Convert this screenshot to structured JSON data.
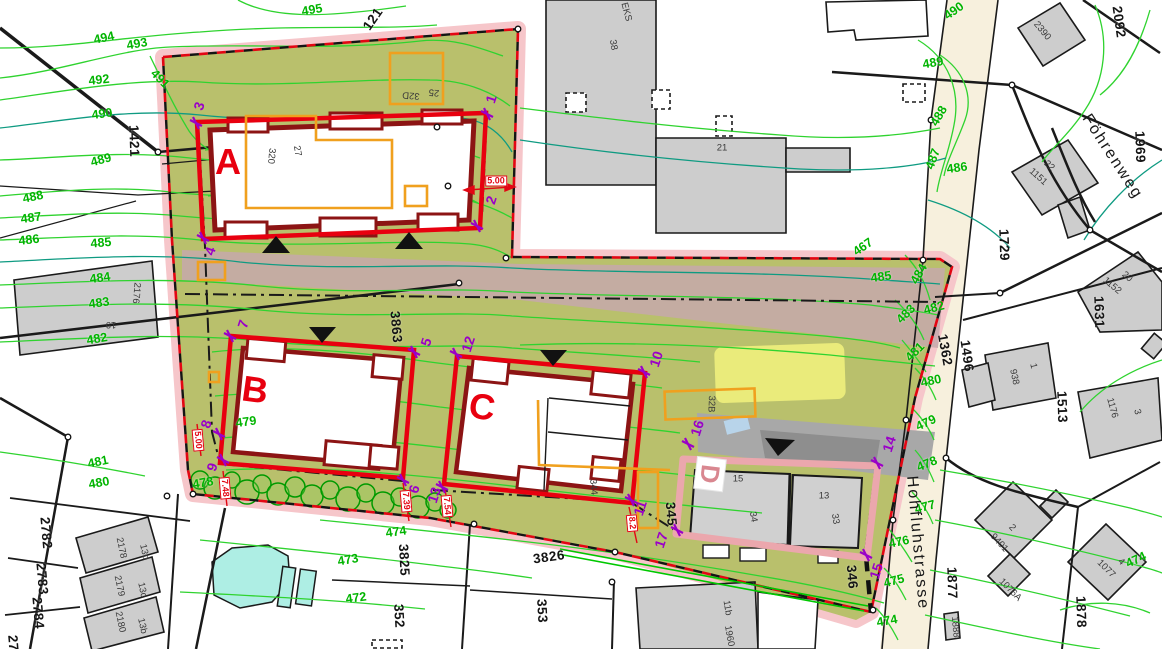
{
  "map": {
    "title": "site-development-plan",
    "colors": {
      "site_area": "#b9c06c",
      "boundary_band": "#f6c6ca",
      "road_reserve": "#c5a8ab",
      "street_fill": "#f7f0dd",
      "special_zone_yellow": "#f2f27e",
      "water": "#aeeee4",
      "contour": "#2fd32f",
      "contour_index": "#0f9b82",
      "contour_label": "#00b400",
      "new_building_red": "#e8000f",
      "wall_maroon": "#8c1414",
      "demolition_orange": "#f0a01e",
      "survey_purple": "#9a00c8",
      "existing_building_gray": "#cdcdcd"
    },
    "streets": [
      {
        "t": "Föhrenweg",
        "x": 1112,
        "y": 157,
        "r": 57
      },
      {
        "t": "Hohfluhstrasse",
        "x": 917,
        "y": 543,
        "r": 85
      }
    ],
    "blocks": [
      {
        "t": "A",
        "x": 228,
        "y": 162,
        "r": 0
      },
      {
        "t": "B",
        "x": 255,
        "y": 390,
        "r": 8
      },
      {
        "t": "C",
        "x": 482,
        "y": 407,
        "r": 8
      },
      {
        "t": "D",
        "x": 710,
        "y": 474,
        "r": 97,
        "boxed": true
      }
    ],
    "contours": [
      {
        "t": "495",
        "x": 312,
        "y": 10,
        "r": -10
      },
      {
        "t": "494",
        "x": 104,
        "y": 38,
        "r": -12
      },
      {
        "t": "493",
        "x": 137,
        "y": 44,
        "r": -10
      },
      {
        "t": "492",
        "x": 99,
        "y": 80,
        "r": -6
      },
      {
        "t": "491",
        "x": 160,
        "y": 79,
        "r": 45
      },
      {
        "t": "490",
        "x": 102,
        "y": 114,
        "r": -8
      },
      {
        "t": "489",
        "x": 101,
        "y": 160,
        "r": -15
      },
      {
        "t": "488",
        "x": 33,
        "y": 197,
        "r": -12
      },
      {
        "t": "487",
        "x": 31,
        "y": 218,
        "r": -8
      },
      {
        "t": "486",
        "x": 29,
        "y": 240,
        "r": -6
      },
      {
        "t": "485",
        "x": 101,
        "y": 243,
        "r": -5
      },
      {
        "t": "484",
        "x": 100,
        "y": 278,
        "r": -8
      },
      {
        "t": "483",
        "x": 99,
        "y": 303,
        "r": -8
      },
      {
        "t": "482",
        "x": 97,
        "y": 339,
        "r": -10
      },
      {
        "t": "481",
        "x": 98,
        "y": 462,
        "r": -12
      },
      {
        "t": "480",
        "x": 99,
        "y": 483,
        "r": -10
      },
      {
        "t": "479",
        "x": 246,
        "y": 422,
        "r": -8
      },
      {
        "t": "478",
        "x": 203,
        "y": 483,
        "r": -10
      },
      {
        "t": "474",
        "x": 396,
        "y": 532,
        "r": -8
      },
      {
        "t": "473",
        "x": 348,
        "y": 560,
        "r": -10
      },
      {
        "t": "472",
        "x": 356,
        "y": 598,
        "r": -8
      },
      {
        "t": "490",
        "x": 954,
        "y": 11,
        "r": -35
      },
      {
        "t": "489",
        "x": 933,
        "y": 63,
        "r": -10
      },
      {
        "t": "488",
        "x": 939,
        "y": 116,
        "r": -60
      },
      {
        "t": "487",
        "x": 933,
        "y": 159,
        "r": -70
      },
      {
        "t": "486",
        "x": 957,
        "y": 168,
        "r": -8
      },
      {
        "t": "485",
        "x": 881,
        "y": 277,
        "r": -8
      },
      {
        "t": "484",
        "x": 919,
        "y": 274,
        "r": -60
      },
      {
        "t": "483",
        "x": 906,
        "y": 314,
        "r": -45
      },
      {
        "t": "482",
        "x": 934,
        "y": 308,
        "r": -15
      },
      {
        "t": "481",
        "x": 915,
        "y": 352,
        "r": -45
      },
      {
        "t": "480",
        "x": 931,
        "y": 381,
        "r": -12
      },
      {
        "t": "479",
        "x": 926,
        "y": 423,
        "r": -25
      },
      {
        "t": "478",
        "x": 927,
        "y": 464,
        "r": -22
      },
      {
        "t": "477",
        "x": 925,
        "y": 507,
        "r": -15
      },
      {
        "t": "476",
        "x": 899,
        "y": 542,
        "r": -12
      },
      {
        "t": "475",
        "x": 894,
        "y": 581,
        "r": -15
      },
      {
        "t": "474",
        "x": 887,
        "y": 621,
        "r": -10
      },
      {
        "t": "474",
        "x": 1136,
        "y": 560,
        "r": -25
      },
      {
        "t": "467",
        "x": 863,
        "y": 247,
        "r": -35
      }
    ],
    "parcels": [
      {
        "t": "1421",
        "x": 134,
        "y": 141,
        "r": 88
      },
      {
        "t": "121",
        "x": 373,
        "y": 19,
        "r": -55
      },
      {
        "t": "3863",
        "x": 396,
        "y": 327,
        "r": 85
      },
      {
        "t": "2782",
        "x": 46,
        "y": 533,
        "r": 85
      },
      {
        "t": "2783",
        "x": 42,
        "y": 579,
        "r": 85
      },
      {
        "t": "2784",
        "x": 38,
        "y": 613,
        "r": 85
      },
      {
        "t": "27",
        "x": 13,
        "y": 643,
        "r": 85
      },
      {
        "t": "3825",
        "x": 404,
        "y": 560,
        "r": 87
      },
      {
        "t": "3826",
        "x": 549,
        "y": 557,
        "r": -8
      },
      {
        "t": "352",
        "x": 399,
        "y": 616,
        "r": 87
      },
      {
        "t": "353",
        "x": 542,
        "y": 611,
        "r": 87
      },
      {
        "t": "345",
        "x": 671,
        "y": 514,
        "r": 85
      },
      {
        "t": "346",
        "x": 852,
        "y": 577,
        "r": 85
      },
      {
        "t": "1362",
        "x": 945,
        "y": 350,
        "r": 80
      },
      {
        "t": "1496",
        "x": 967,
        "y": 356,
        "r": 82
      },
      {
        "t": "1513",
        "x": 1062,
        "y": 407,
        "r": 88
      },
      {
        "t": "1631",
        "x": 1099,
        "y": 312,
        "r": 88
      },
      {
        "t": "1729",
        "x": 1004,
        "y": 245,
        "r": 88
      },
      {
        "t": "1877",
        "x": 952,
        "y": 583,
        "r": 88
      },
      {
        "t": "1878",
        "x": 1081,
        "y": 612,
        "r": 88
      },
      {
        "t": "1969",
        "x": 1140,
        "y": 147,
        "r": 88
      },
      {
        "t": "2092",
        "x": 1119,
        "y": 22,
        "r": 82
      }
    ],
    "buildings": [
      {
        "t": "2176",
        "x": 136,
        "y": 293,
        "r": 95
      },
      {
        "t": "19",
        "x": 111,
        "y": 324,
        "r": 180
      },
      {
        "t": "320",
        "x": 271,
        "y": 156,
        "r": 95
      },
      {
        "t": "27",
        "x": 297,
        "y": 151,
        "r": 80
      },
      {
        "t": "32D",
        "x": 411,
        "y": 95,
        "r": 185
      },
      {
        "t": "25",
        "x": 434,
        "y": 92,
        "r": 185
      },
      {
        "t": "38",
        "x": 613,
        "y": 45,
        "r": 80
      },
      {
        "t": "21",
        "x": 722,
        "y": 148,
        "r": 0
      },
      {
        "t": "EKS",
        "x": 626,
        "y": 12,
        "r": 75
      },
      {
        "t": "2390",
        "x": 1042,
        "y": 31,
        "r": 50
      },
      {
        "t": "1151",
        "x": 1038,
        "y": 177,
        "r": 42
      },
      {
        "t": "22",
        "x": 1049,
        "y": 166,
        "r": 42
      },
      {
        "t": "1152",
        "x": 1112,
        "y": 286,
        "r": 40
      },
      {
        "t": "20",
        "x": 1127,
        "y": 277,
        "r": 40
      },
      {
        "t": "938",
        "x": 1014,
        "y": 377,
        "r": 78
      },
      {
        "t": "1",
        "x": 1033,
        "y": 366,
        "r": 78
      },
      {
        "t": "1176",
        "x": 1112,
        "y": 408,
        "r": 75
      },
      {
        "t": "3",
        "x": 1137,
        "y": 412,
        "r": 75
      },
      {
        "t": "9401",
        "x": 999,
        "y": 543,
        "r": 48
      },
      {
        "t": "2",
        "x": 1012,
        "y": 528,
        "r": 48
      },
      {
        "t": "1076A",
        "x": 1010,
        "y": 590,
        "r": 45
      },
      {
        "t": "1077",
        "x": 1106,
        "y": 569,
        "r": 45
      },
      {
        "t": "4",
        "x": 1121,
        "y": 562,
        "r": 45
      },
      {
        "t": "1888",
        "x": 955,
        "y": 627,
        "r": 85
      },
      {
        "t": "1960",
        "x": 729,
        "y": 636,
        "r": 80
      },
      {
        "t": "11b",
        "x": 727,
        "y": 608,
        "r": 80
      },
      {
        "t": "2178",
        "x": 121,
        "y": 548,
        "r": 78
      },
      {
        "t": "13d",
        "x": 144,
        "y": 552,
        "r": 78
      },
      {
        "t": "2179",
        "x": 119,
        "y": 586,
        "r": 78
      },
      {
        "t": "13c",
        "x": 142,
        "y": 590,
        "r": 78
      },
      {
        "t": "2180",
        "x": 120,
        "y": 622,
        "r": 78
      },
      {
        "t": "13b",
        "x": 142,
        "y": 626,
        "r": 78
      },
      {
        "t": "344",
        "x": 593,
        "y": 487,
        "r": 85
      },
      {
        "t": "15",
        "x": 738,
        "y": 479,
        "r": 0
      },
      {
        "t": "34",
        "x": 753,
        "y": 517,
        "r": 80
      },
      {
        "t": "13",
        "x": 824,
        "y": 496,
        "r": 0
      },
      {
        "t": "33",
        "x": 835,
        "y": 519,
        "r": 80
      },
      {
        "t": "32B",
        "x": 711,
        "y": 404,
        "r": 92
      }
    ],
    "dims": [
      {
        "t": "5.00",
        "x": 496,
        "y": 181,
        "r": 0
      },
      {
        "t": "5.00",
        "x": 198,
        "y": 440,
        "r": 85
      },
      {
        "t": "7.48",
        "x": 225,
        "y": 488,
        "r": 85
      },
      {
        "t": "7.39",
        "x": 406,
        "y": 501,
        "r": 85
      },
      {
        "t": "7.54",
        "x": 447,
        "y": 506,
        "r": 85
      },
      {
        "t": "8.2",
        "x": 632,
        "y": 523,
        "r": 85
      }
    ],
    "survey_points": [
      {
        "n": "1",
        "lx": 491,
        "ly": 99,
        "cx": 487,
        "cy": 114
      },
      {
        "n": "2",
        "lx": 491,
        "ly": 200,
        "cx": 477,
        "cy": 226
      },
      {
        "n": "3",
        "lx": 199,
        "ly": 106,
        "cx": 196,
        "cy": 123
      },
      {
        "n": "4",
        "lx": 210,
        "ly": 251,
        "cx": 203,
        "cy": 238
      },
      {
        "n": "5",
        "lx": 426,
        "ly": 342,
        "cx": 414,
        "cy": 352
      },
      {
        "n": "6",
        "lx": 414,
        "ly": 489,
        "cx": 403,
        "cy": 480
      },
      {
        "n": "7",
        "lx": 243,
        "ly": 324,
        "cx": 230,
        "cy": 336
      },
      {
        "n": "8",
        "lx": 206,
        "ly": 424,
        "cx": 219,
        "cy": 434
      },
      {
        "n": "9",
        "lx": 212,
        "ly": 467,
        "cx": 223,
        "cy": 460
      },
      {
        "n": "10",
        "lx": 656,
        "ly": 359,
        "cx": 644,
        "cy": 372
      },
      {
        "n": "11",
        "lx": 640,
        "ly": 508,
        "cx": 631,
        "cy": 500
      },
      {
        "n": "12",
        "lx": 468,
        "ly": 344,
        "cx": 456,
        "cy": 354
      },
      {
        "n": "13",
        "lx": 434,
        "ly": 495,
        "cx": 442,
        "cy": 487
      },
      {
        "n": "14",
        "lx": 889,
        "ly": 444,
        "cx": 877,
        "cy": 463
      },
      {
        "n": "15",
        "lx": 876,
        "ly": 571,
        "cx": 866,
        "cy": 555
      },
      {
        "n": "16",
        "lx": 697,
        "ly": 428,
        "cx": 688,
        "cy": 444
      },
      {
        "n": "17",
        "lx": 661,
        "ly": 540,
        "cx": 677,
        "cy": 530
      }
    ]
  }
}
